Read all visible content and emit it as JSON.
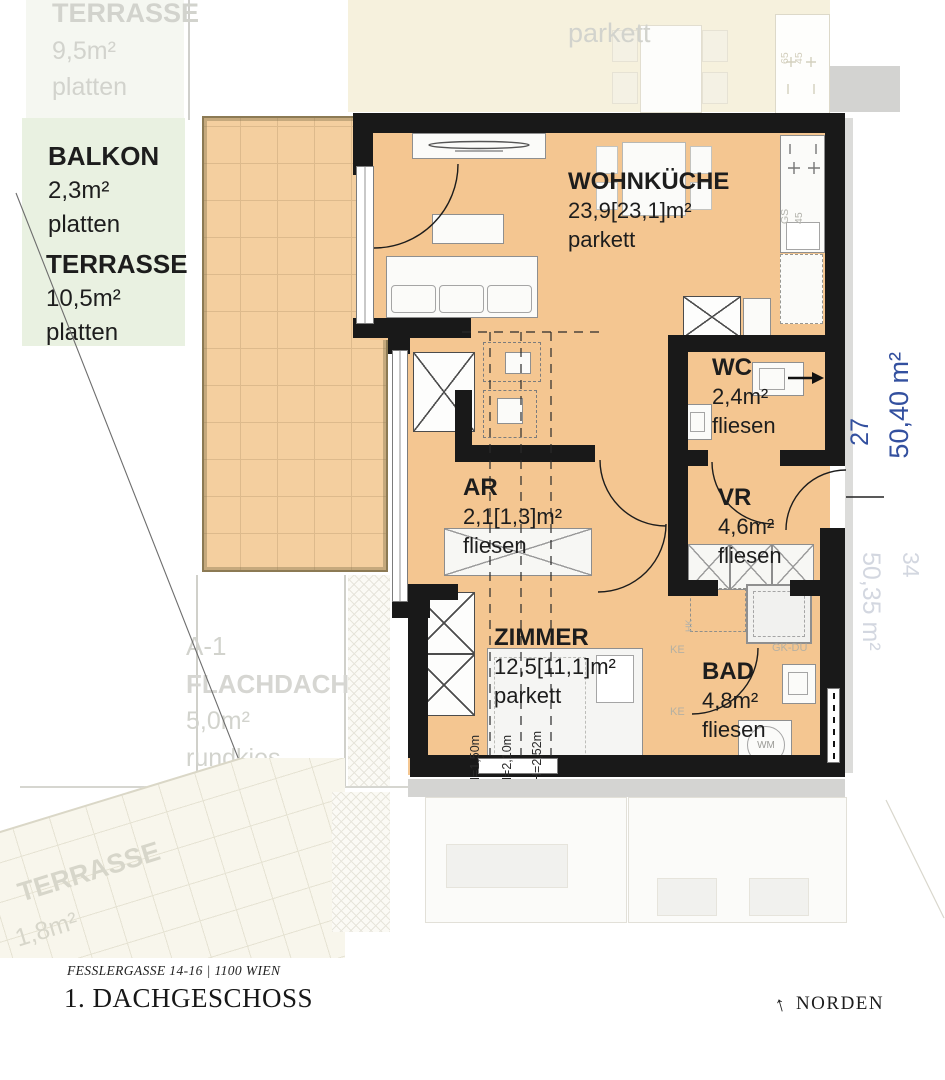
{
  "meta": {
    "address": "FESSLERGASSE 14-16 | 1100 WIEN",
    "floor_title": "1. DACHGESCHOSS",
    "north_label": "NORDEN",
    "north_arrow": "↑"
  },
  "unit": {
    "number": "27",
    "total_area": "50,40 m²",
    "rooms": [
      {
        "name": "WOHNKÜCHE",
        "area": "23,9[23,1]m²",
        "floor": "parkett"
      },
      {
        "name": "WC",
        "area": "2,4m²",
        "floor": "fliesen"
      },
      {
        "name": "AR",
        "area": "2,1[1,3]m²",
        "floor": "fliesen"
      },
      {
        "name": "VR",
        "area": "4,6m²",
        "floor": "fliesen"
      },
      {
        "name": "ZIMMER",
        "area": "12,5[11,1]m²",
        "floor": "parkett"
      },
      {
        "name": "BAD",
        "area": "4,8m²",
        "floor": "fliesen"
      }
    ],
    "outdoor": [
      {
        "name": "BALKON",
        "area": "2,3m²",
        "floor": "platten"
      },
      {
        "name": "TERRASSE",
        "area": "10,5m²",
        "floor": "platten"
      }
    ],
    "height_lines": [
      {
        "label": "H=1,50m"
      },
      {
        "label": "H=2,10m"
      },
      {
        "label": "H=2,52m"
      }
    ],
    "fixtures": {
      "washing_machine": "WM",
      "dishwasher": "GS",
      "dishwasher_width": "45",
      "radiator": "HK",
      "shower": "GK-DU",
      "kitchen_unit": "KE",
      "stove_depth": "65",
      "stove_width": "45"
    }
  },
  "neighbor": {
    "unit_below_number": "34",
    "unit_below_area": "50,35 m²",
    "terrace_top": {
      "name": "TERRASSE",
      "area": "9,5m²",
      "floor": "platten"
    },
    "flat_roof": {
      "id": "A-1",
      "name": "FLACHDACH",
      "area": "5,0m²",
      "floor": "rundkies"
    },
    "terrace_bottom": {
      "name": "TERRASSE",
      "area": "1,8m²"
    },
    "floor_label": "parkett"
  }
}
